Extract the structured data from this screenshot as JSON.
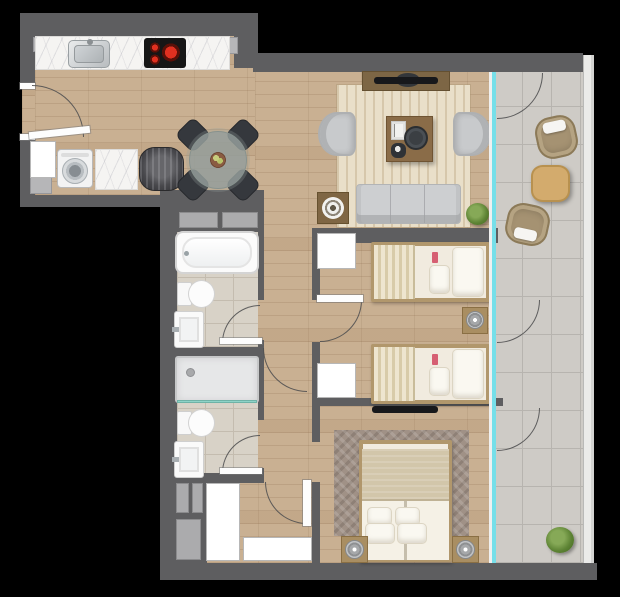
{
  "plan": {
    "kind": "apartment-floor-plan-top-view",
    "width": 620,
    "height": 597
  },
  "colors": {
    "bg": "#000000",
    "wall": "#5e5e60",
    "wood": "#c9b092",
    "tile_balcony": "#cecbc6",
    "tile_bath": "#d8d2c7",
    "glass": "#76dfe9",
    "marble": "#f5f4f2",
    "rug_living": "#e9dfc9",
    "rug_master": "#a09186",
    "sofa_gray": "#cdcfd1",
    "chair_dark": "#35383d",
    "wood_furniture": "#a98e62",
    "balcony_furniture": "#a59272",
    "plant_green": "#5d8334",
    "burner_red": "#e03020"
  },
  "elements": [
    {
      "name": "floor-entry-kitchen",
      "cls": "wood",
      "x": 35,
      "y": 36,
      "w": 223,
      "h": 159
    },
    {
      "name": "floor-main-living-bedrooms",
      "cls": "wood",
      "x": 255,
      "y": 72,
      "w": 238,
      "h": 491
    },
    {
      "name": "floor-hall-bottom",
      "cls": "wood",
      "x": 205,
      "y": 478,
      "w": 57,
      "h": 85
    },
    {
      "name": "floor-entry-door-gap",
      "cls": "wood",
      "x": 22,
      "y": 88,
      "w": 13,
      "h": 47
    },
    {
      "name": "floor-balcony",
      "cls": "tile-balcony",
      "x": 493,
      "y": 72,
      "w": 90,
      "h": 491
    },
    {
      "name": "floor-bathroom-1",
      "cls": "tile-bath",
      "x": 177,
      "y": 232,
      "w": 81,
      "h": 115
    },
    {
      "name": "floor-bathroom-2",
      "cls": "tile-bath",
      "x": 177,
      "y": 357,
      "w": 81,
      "h": 121
    },
    {
      "name": "rug-living-room",
      "cls": "rug-living",
      "x": 337,
      "y": 85,
      "w": 133,
      "h": 142
    },
    {
      "name": "rug-master-bedroom",
      "cls": "rug-master",
      "x": 334,
      "y": 430,
      "w": 135,
      "h": 106
    },
    {
      "name": "wall-kitchen-top",
      "cls": "wall",
      "x": 20,
      "y": 13,
      "w": 238,
      "h": 23
    },
    {
      "name": "wall-kitchen-step",
      "cls": "wall",
      "x": 234,
      "y": 13,
      "w": 24,
      "h": 55
    },
    {
      "name": "wall-living-top",
      "cls": "wall",
      "x": 253,
      "y": 53,
      "w": 330,
      "h": 19
    },
    {
      "name": "wall-left-upper",
      "cls": "wall",
      "x": 20,
      "y": 13,
      "w": 15,
      "h": 75
    },
    {
      "name": "wall-left-mid",
      "cls": "wall",
      "x": 20,
      "y": 135,
      "w": 15,
      "h": 62
    },
    {
      "name": "wall-entry-bottom",
      "cls": "wall",
      "x": 20,
      "y": 195,
      "w": 145,
      "h": 12
    },
    {
      "name": "wall-bath-left-spine",
      "cls": "wall",
      "x": 160,
      "y": 207,
      "w": 17,
      "h": 356
    },
    {
      "name": "wall-bath-top",
      "cls": "wall",
      "x": 160,
      "y": 190,
      "w": 104,
      "h": 42
    },
    {
      "name": "wall-bath-right-a",
      "cls": "wall",
      "x": 258,
      "y": 207,
      "w": 6,
      "h": 93
    },
    {
      "name": "wall-bath-right-b",
      "cls": "wall",
      "x": 258,
      "y": 340,
      "w": 6,
      "h": 80
    },
    {
      "name": "wall-bath-right-c",
      "cls": "wall",
      "x": 258,
      "y": 468,
      "w": 6,
      "h": 15
    },
    {
      "name": "wall-bath-divider",
      "cls": "wall",
      "x": 177,
      "y": 347,
      "w": 87,
      "h": 10
    },
    {
      "name": "wall-bath-bottom",
      "cls": "wall",
      "x": 160,
      "y": 473,
      "w": 104,
      "h": 10
    },
    {
      "name": "wall-bottom-left-block",
      "cls": "wall",
      "x": 160,
      "y": 475,
      "w": 47,
      "h": 88
    },
    {
      "name": "wall-bedroom1-top",
      "cls": "wall",
      "x": 312,
      "y": 228,
      "w": 186,
      "h": 15
    },
    {
      "name": "wall-bedroom-left-a",
      "cls": "wall",
      "x": 312,
      "y": 243,
      "w": 8,
      "h": 57
    },
    {
      "name": "wall-bedroom-left-b",
      "cls": "wall",
      "x": 312,
      "y": 342,
      "w": 8,
      "h": 64
    },
    {
      "name": "wall-bedroom2-bottom",
      "cls": "wall",
      "x": 312,
      "y": 398,
      "w": 191,
      "h": 8
    },
    {
      "name": "wall-master-left-a",
      "cls": "wall",
      "x": 312,
      "y": 406,
      "w": 8,
      "h": 36
    },
    {
      "name": "wall-master-left-b",
      "cls": "wall",
      "x": 312,
      "y": 482,
      "w": 8,
      "h": 81
    },
    {
      "name": "wall-bottom-outer",
      "cls": "wall",
      "x": 160,
      "y": 563,
      "w": 437,
      "h": 17
    },
    {
      "name": "column-kitchen-left",
      "cls": "col",
      "x": 33,
      "y": 37,
      "w": 16,
      "h": 15
    },
    {
      "name": "column-kitchen-right",
      "cls": "col",
      "x": 219,
      "y": 37,
      "w": 19,
      "h": 17
    },
    {
      "name": "column-entry",
      "cls": "col",
      "x": 30,
      "y": 177,
      "w": 22,
      "h": 17
    },
    {
      "name": "shaft-bath-top-a",
      "cls": "shaft",
      "x": 179,
      "y": 212,
      "w": 39,
      "h": 16
    },
    {
      "name": "shaft-bath-top-b",
      "cls": "shaft",
      "x": 222,
      "y": 212,
      "w": 36,
      "h": 16
    },
    {
      "name": "shaft-bottom-a",
      "cls": "shaft",
      "x": 176,
      "y": 483,
      "w": 13,
      "h": 30
    },
    {
      "name": "shaft-bottom-b",
      "cls": "shaft",
      "x": 192,
      "y": 483,
      "w": 11,
      "h": 30
    },
    {
      "name": "shaft-bottom-c",
      "cls": "shaft",
      "x": 176,
      "y": 519,
      "w": 25,
      "h": 41
    },
    {
      "name": "cabinet-entry",
      "cls": "closet",
      "x": 30,
      "y": 141,
      "w": 26,
      "h": 37
    },
    {
      "name": "closet-hall",
      "cls": "closet",
      "x": 206,
      "y": 483,
      "w": 34,
      "h": 78
    },
    {
      "name": "closet-hall-2",
      "cls": "closet",
      "x": 243,
      "y": 537,
      "w": 69,
      "h": 24
    },
    {
      "name": "closet-bedroom-1",
      "cls": "closet",
      "x": 317,
      "y": 233,
      "w": 39,
      "h": 36
    },
    {
      "name": "closet-bedroom-2",
      "cls": "closet",
      "x": 317,
      "y": 363,
      "w": 39,
      "h": 35
    },
    {
      "name": "sill-entry-top",
      "cls": "leaf",
      "x": 20,
      "y": 83,
      "w": 15,
      "h": 6
    },
    {
      "name": "sill-entry-bottom",
      "cls": "leaf",
      "x": 20,
      "y": 134,
      "w": 15,
      "h": 6
    },
    {
      "name": "kitchen-counter",
      "cls": "counter",
      "x": 35,
      "y": 36,
      "w": 195,
      "h": 34
    },
    {
      "name": "kitchen-sink",
      "cls": "sink-kitchen",
      "x": 68,
      "y": 40,
      "w": 42,
      "h": 28
    },
    {
      "name": "stove-cooktop",
      "cls": "stove",
      "x": 144,
      "y": 38,
      "w": 42,
      "h": 30
    },
    {
      "name": "washing-machine",
      "cls": "washer",
      "x": 57,
      "y": 149,
      "w": 36,
      "h": 39
    },
    {
      "name": "laundry-counter",
      "cls": "counter",
      "x": 95,
      "y": 149,
      "w": 43,
      "h": 41
    },
    {
      "name": "water-heater",
      "cls": "heater",
      "x": 139,
      "y": 147,
      "w": 45,
      "h": 44
    },
    {
      "name": "dining-chair-nw",
      "cls": "chair-dark",
      "x": 180,
      "y": 122,
      "w": 26,
      "h": 26,
      "rot": 45
    },
    {
      "name": "dining-chair-ne",
      "cls": "chair-dark",
      "x": 230,
      "y": 122,
      "w": 26,
      "h": 26,
      "rot": 45
    },
    {
      "name": "dining-chair-sw",
      "cls": "chair-dark",
      "x": 180,
      "y": 172,
      "w": 26,
      "h": 26,
      "rot": 45
    },
    {
      "name": "dining-chair-se",
      "cls": "chair-dark",
      "x": 230,
      "y": 172,
      "w": 26,
      "h": 26,
      "rot": 45
    },
    {
      "name": "dining-table",
      "cls": "dining-table",
      "x": 189,
      "y": 131,
      "w": 58,
      "h": 58
    },
    {
      "name": "fruit-bowl",
      "cls": "bowl",
      "x": 210,
      "y": 152,
      "w": 16,
      "h": 16
    },
    {
      "name": "tv-console-living",
      "cls": "tv-console",
      "x": 362,
      "y": 71,
      "w": 88,
      "h": 20
    },
    {
      "name": "tv-disc-living",
      "cls": "tv-disc",
      "x": 396,
      "y": 73,
      "w": 24,
      "h": 14
    },
    {
      "name": "tv-living",
      "cls": "tv-bar",
      "x": 374,
      "y": 77,
      "w": 64,
      "h": 7
    },
    {
      "name": "armchair-left",
      "cls": "armchair-w",
      "x": 318,
      "y": 112,
      "w": 38,
      "h": 44
    },
    {
      "name": "armchair-right",
      "cls": "armchair-e",
      "x": 453,
      "y": 112,
      "w": 38,
      "h": 44
    },
    {
      "name": "coffee-table",
      "cls": "coffee-table",
      "x": 386,
      "y": 116,
      "w": 47,
      "h": 46
    },
    {
      "name": "book-stack",
      "cls": "book-stack",
      "x": 391,
      "y": 121,
      "w": 15,
      "h": 19
    },
    {
      "name": "decor-tray",
      "cls": "tray",
      "x": 404,
      "y": 126,
      "w": 24,
      "h": 24
    },
    {
      "name": "decor-bowl",
      "cls": "small-bowl",
      "x": 391,
      "y": 143,
      "w": 15,
      "h": 15
    },
    {
      "name": "sofa",
      "cls": "sofa",
      "x": 356,
      "y": 184,
      "w": 105,
      "h": 40
    },
    {
      "name": "side-table",
      "cls": "side-table",
      "x": 317,
      "y": 192,
      "w": 32,
      "h": 32
    },
    {
      "name": "side-table-decor",
      "cls": "rings",
      "x": 322,
      "y": 197,
      "w": 22,
      "h": 22
    },
    {
      "name": "plant-living",
      "cls": "plant",
      "x": 466,
      "y": 203,
      "w": 23,
      "h": 22
    },
    {
      "name": "bed-single-1",
      "cls": "bed-frame",
      "x": 371,
      "y": 242,
      "w": 119,
      "h": 60
    },
    {
      "name": "bed1-blanket",
      "cls": "blanket-striped",
      "x": 374,
      "y": 245,
      "w": 41,
      "h": 54
    },
    {
      "name": "bed1-pillow-large",
      "cls": "pillow",
      "x": 452,
      "y": 247,
      "w": 32,
      "h": 50
    },
    {
      "name": "bed1-pillow-small",
      "cls": "pillow",
      "x": 429,
      "y": 265,
      "w": 21,
      "h": 29
    },
    {
      "name": "bed1-tag",
      "cls": "tag",
      "x": 432,
      "y": 252,
      "w": 6,
      "h": 11
    },
    {
      "name": "nightstand-bedroom",
      "cls": "nightstand",
      "x": 462,
      "y": 307,
      "w": 26,
      "h": 27
    },
    {
      "name": "lamp-bedroom",
      "cls": "lamp",
      "x": 466,
      "y": 311,
      "w": 18,
      "h": 18
    },
    {
      "name": "bed-single-2",
      "cls": "bed-frame",
      "x": 371,
      "y": 344,
      "w": 119,
      "h": 60
    },
    {
      "name": "bed2-blanket",
      "cls": "blanket-striped",
      "x": 374,
      "y": 347,
      "w": 41,
      "h": 54
    },
    {
      "name": "bed2-pillow-large",
      "cls": "pillow",
      "x": 452,
      "y": 349,
      "w": 32,
      "h": 50
    },
    {
      "name": "bed2-pillow-small",
      "cls": "pillow",
      "x": 429,
      "y": 367,
      "w": 21,
      "h": 29
    },
    {
      "name": "bed2-tag",
      "cls": "tag",
      "x": 432,
      "y": 354,
      "w": 6,
      "h": 11
    },
    {
      "name": "tv-master",
      "cls": "tv-bar",
      "x": 372,
      "y": 406,
      "w": 66,
      "h": 7
    },
    {
      "name": "bed-master",
      "cls": "bed-frame",
      "x": 359,
      "y": 440,
      "w": 93,
      "h": 122
    },
    {
      "name": "master-blanket",
      "cls": "blanket-plain",
      "x": 362,
      "y": 449,
      "w": 87,
      "h": 52
    },
    {
      "name": "master-duvet",
      "cls": "duvet",
      "x": 362,
      "y": 501,
      "w": 87,
      "h": 59
    },
    {
      "name": "master-pillow-1",
      "cls": "pillow",
      "x": 367,
      "y": 507,
      "w": 25,
      "h": 19
    },
    {
      "name": "master-pillow-2",
      "cls": "pillow",
      "x": 395,
      "y": 507,
      "w": 25,
      "h": 19
    },
    {
      "name": "master-pillow-3",
      "cls": "pillow",
      "x": 365,
      "y": 523,
      "w": 30,
      "h": 21
    },
    {
      "name": "nightstand-master-left",
      "cls": "nightstand",
      "x": 341,
      "y": 536,
      "w": 27,
      "h": 27
    },
    {
      "name": "lamp-master-left",
      "cls": "lamp",
      "x": 345,
      "y": 540,
      "w": 19,
      "h": 19
    },
    {
      "name": "master-pillow-4",
      "cls": "pillow",
      "x": 397,
      "y": 523,
      "w": 30,
      "h": 21
    },
    {
      "name": "nightstand-master-right",
      "cls": "nightstand",
      "x": 452,
      "y": 536,
      "w": 27,
      "h": 27
    },
    {
      "name": "lamp-master-right",
      "cls": "lamp",
      "x": 456,
      "y": 540,
      "w": 19,
      "h": 19
    },
    {
      "name": "bathtub",
      "cls": "tub",
      "x": 175,
      "y": 231,
      "w": 84,
      "h": 43
    },
    {
      "name": "toilet-bath1",
      "cls": "toilet-e",
      "x": 177,
      "y": 280,
      "w": 38,
      "h": 28
    },
    {
      "name": "sink-bath1",
      "cls": "sink-bath",
      "x": 174,
      "y": 311,
      "w": 30,
      "h": 37
    },
    {
      "name": "shower",
      "cls": "shower",
      "x": 175,
      "y": 356,
      "w": 84,
      "h": 47
    },
    {
      "name": "shower-glass",
      "cls": "glassline",
      "x": 177,
      "y": 400,
      "w": 80,
      "h": 3
    },
    {
      "name": "toilet-bath2",
      "cls": "toilet-e",
      "x": 177,
      "y": 409,
      "w": 38,
      "h": 28
    },
    {
      "name": "sink-bath2",
      "cls": "sink-bath",
      "x": 174,
      "y": 441,
      "w": 30,
      "h": 37
    },
    {
      "name": "balcony-chair-top",
      "cls": "bchair-n",
      "x": 536,
      "y": 116,
      "w": 41,
      "h": 42,
      "rot": -12
    },
    {
      "name": "balcony-table",
      "cls": "btable",
      "x": 531,
      "y": 165,
      "w": 39,
      "h": 37
    },
    {
      "name": "balcony-chair-bottom",
      "cls": "bchair-s",
      "x": 506,
      "y": 204,
      "w": 43,
      "h": 41,
      "rot": 12
    },
    {
      "name": "plant-balcony",
      "cls": "plant",
      "x": 546,
      "y": 527,
      "w": 28,
      "h": 26
    },
    {
      "name": "window-frame",
      "cls": "glass-frame",
      "x": 489,
      "y": 72,
      "w": 3,
      "h": 491
    },
    {
      "name": "window-glass-wall",
      "cls": "glass",
      "x": 492,
      "y": 72,
      "w": 4,
      "h": 491
    },
    {
      "name": "balcony-railing",
      "cls": "railing",
      "x": 583,
      "y": 55,
      "w": 11,
      "h": 508
    },
    {
      "name": "door-arc-entry",
      "cls": "arc",
      "x": 32,
      "y": 85,
      "w": 52,
      "h": 52
    },
    {
      "name": "door-leaf-entry",
      "cls": "leaf",
      "x": 29,
      "y": 129,
      "w": 61,
      "h": 7,
      "rot": -6
    },
    {
      "name": "door-arc-bath1",
      "cls": "arc",
      "x": 222,
      "y": 305,
      "w": 38,
      "h": 38,
      "rot": -90
    },
    {
      "name": "door-leaf-bath1",
      "cls": "leaf",
      "x": 220,
      "y": 338,
      "w": 42,
      "h": 6
    },
    {
      "name": "door-arc-bath2",
      "cls": "arc",
      "x": 222,
      "y": 435,
      "w": 38,
      "h": 38,
      "rot": -90
    },
    {
      "name": "door-leaf-bath2",
      "cls": "leaf",
      "x": 220,
      "y": 468,
      "w": 42,
      "h": 6
    },
    {
      "name": "door-arc-bedroom",
      "cls": "arc",
      "x": 320,
      "y": 300,
      "w": 42,
      "h": 42,
      "rot": 90
    },
    {
      "name": "door-leaf-bedroom",
      "cls": "leaf",
      "x": 317,
      "y": 295,
      "w": 46,
      "h": 7
    },
    {
      "name": "door-arc-hall",
      "cls": "arc",
      "x": 263,
      "y": 348,
      "w": 44,
      "h": 44,
      "rot": 180
    },
    {
      "name": "door-arc-master",
      "cls": "arc",
      "x": 265,
      "y": 482,
      "w": 42,
      "h": 42,
      "rot": 180
    },
    {
      "name": "door-leaf-master",
      "cls": "leaf",
      "x": 303,
      "y": 480,
      "w": 8,
      "h": 46
    },
    {
      "name": "door-arc-balcony-living",
      "cls": "arc",
      "x": 497,
      "y": 73,
      "w": 46,
      "h": 46,
      "rot": 90
    },
    {
      "name": "door-arc-balcony-bedroom",
      "cls": "arc",
      "x": 497,
      "y": 300,
      "w": 43,
      "h": 43,
      "rot": 90
    },
    {
      "name": "door-arc-balcony-master",
      "cls": "arc",
      "x": 497,
      "y": 408,
      "w": 43,
      "h": 43,
      "rot": 90
    }
  ]
}
